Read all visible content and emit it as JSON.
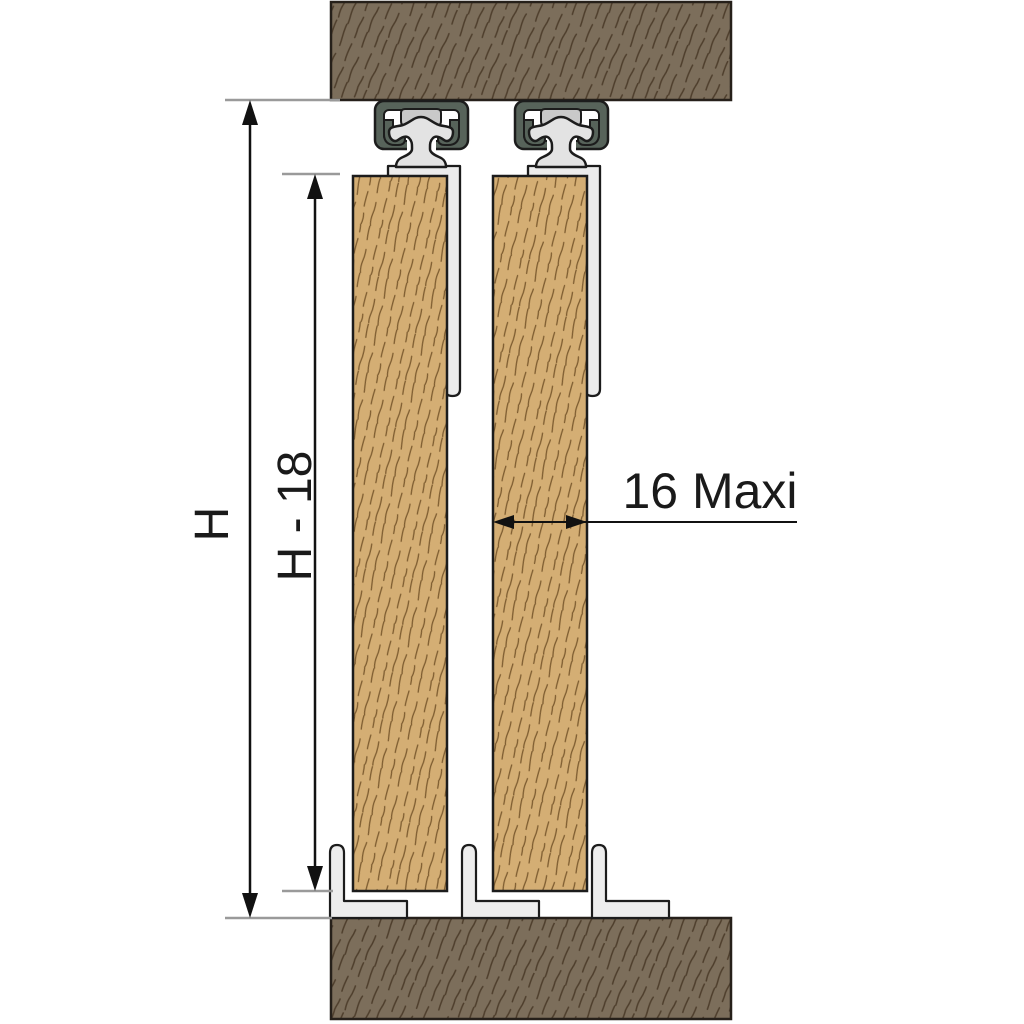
{
  "labels": {
    "opening_height": "H",
    "door_height": "H - 18",
    "door_thickness": "16 Maxi"
  },
  "colors": {
    "background": "#ffffff",
    "beam_fill": "#7c6e5b",
    "beam_grain": "#4e3e2c",
    "door_fill": "#d4ae74",
    "door_grain": "#7d5c30",
    "track_channel": "#57635a",
    "glider_fill": "#e3e3e3",
    "tab_fill": "#c9c9c9",
    "bracket_fill": "#ececec",
    "guide_fill": "#ededed",
    "outline": "#1c1c1c",
    "dim_line": "#111111",
    "tick_line": "#9a9a9a",
    "label_color": "#1a1a1a"
  }
}
